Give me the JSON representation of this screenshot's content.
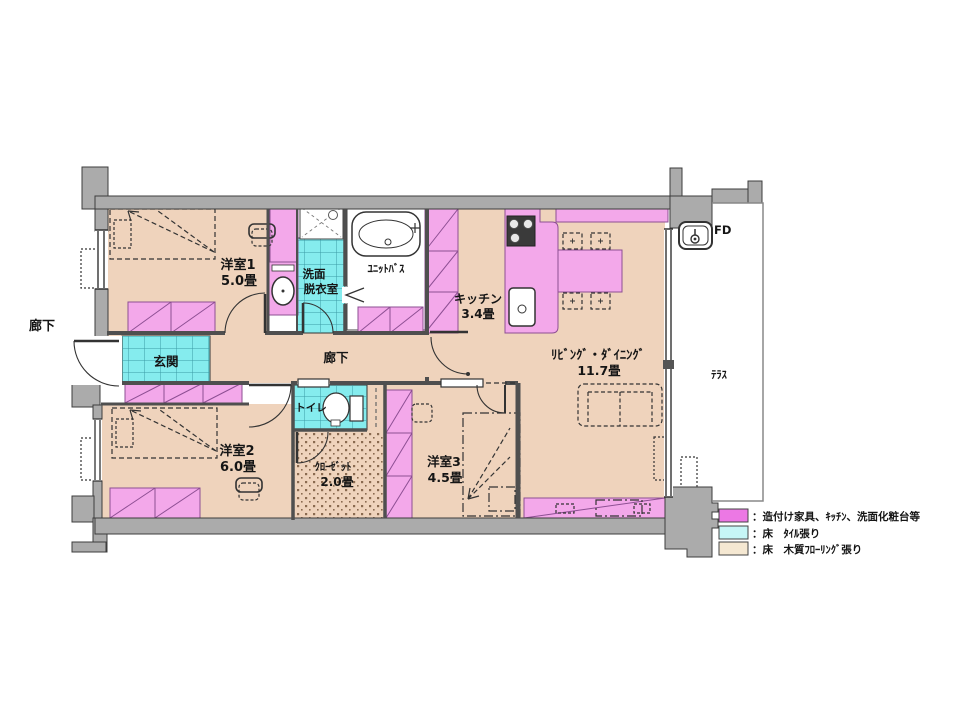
{
  "plan": {
    "corridor_outside": "廊下",
    "room1": {
      "name": "洋室1",
      "size": "5.0畳"
    },
    "washroom": {
      "line1": "洗面",
      "line2": "脱衣室"
    },
    "unit_bath": "ﾕﾆｯﾄﾊﾞｽ",
    "kitchen": {
      "name": "キッチン",
      "size": "3.4畳"
    },
    "living_dining": {
      "name": "ﾘﾋﾞﾝｸﾞ・ﾀﾞｲﾆﾝｸﾞ",
      "size": "11.7畳"
    },
    "entrance": "玄関",
    "corridor": "廊下",
    "room2": {
      "name": "洋室2",
      "size": "6.0畳"
    },
    "toilet": "トイレ",
    "closet": {
      "name": "ｸﾛｰｾﾞｯﾄ",
      "size": "2.0畳"
    },
    "room3": {
      "name": "洋室3",
      "size": "4.5畳"
    },
    "terrace": "ﾃﾗｽ",
    "fire_damper": "FD"
  },
  "legend": {
    "items": [
      {
        "swatch_color": "#ec78e4",
        "label": "：造付け家具、ｷｯﾁﾝ、洗面化粧台等"
      },
      {
        "swatch_color": "#c6f6f6",
        "label": "：床　ﾀｲﾙ張り"
      },
      {
        "swatch_color": "#f5e8d2",
        "label": "：床　木質ﾌﾛｰﾘﾝｸﾞ張り"
      }
    ]
  },
  "colors": {
    "wall_gray": "#ababab",
    "wood_floor": "#efd3bc",
    "tile_cyan": "#85ecee",
    "fixture_pink": "#f3a8ea",
    "fixture_outline": "#8d4f93",
    "line_dark": "#3c3c3c"
  }
}
